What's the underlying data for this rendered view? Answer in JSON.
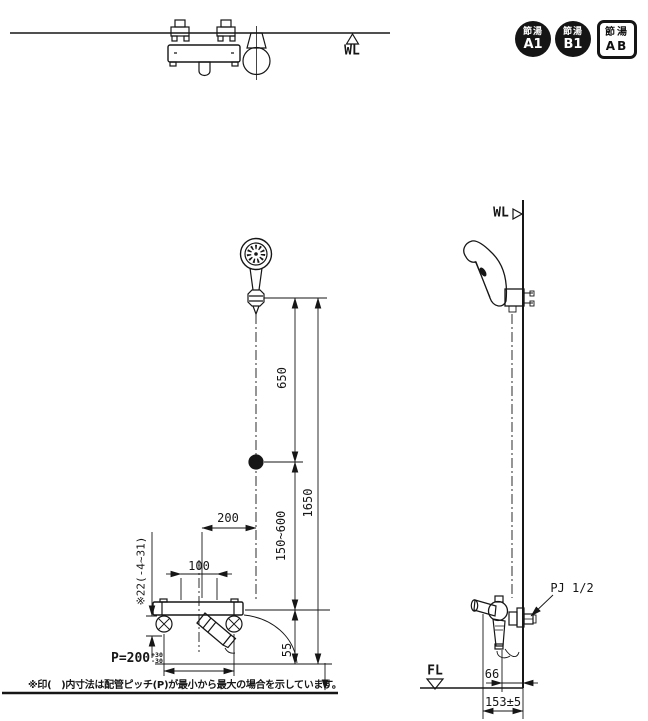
{
  "colors": {
    "ink": "#161616"
  },
  "top_view": {
    "wl_label": "WL"
  },
  "eco_badges": [
    {
      "shape": "circle",
      "top_text": "節湯",
      "bottom_text": "A1"
    },
    {
      "shape": "circle",
      "top_text": "節湯",
      "bottom_text": "B1"
    },
    {
      "shape": "square",
      "top_text": "節湯",
      "bottom_text": "AB"
    }
  ],
  "front_view": {
    "dim_650": "650",
    "dim_1650": "1650",
    "dim_150_600": "150~600",
    "dim_200": "200",
    "dim_100": "100",
    "dim_offset": "※22(-4~31)",
    "dim_55": "55",
    "pitch_prefix": "P=200",
    "pitch_tol_upper": "+30",
    "pitch_tol_lower": "-30"
  },
  "side_view": {
    "wl_label": "WL",
    "fl_label": "FL",
    "pipe_joint_label": "PJ 1/2",
    "dim_66": "66",
    "dim_153": "153±5"
  },
  "footnote": "※印(　)内寸法は配管ピッチ(P)が最小から最大の場合を示しています。"
}
